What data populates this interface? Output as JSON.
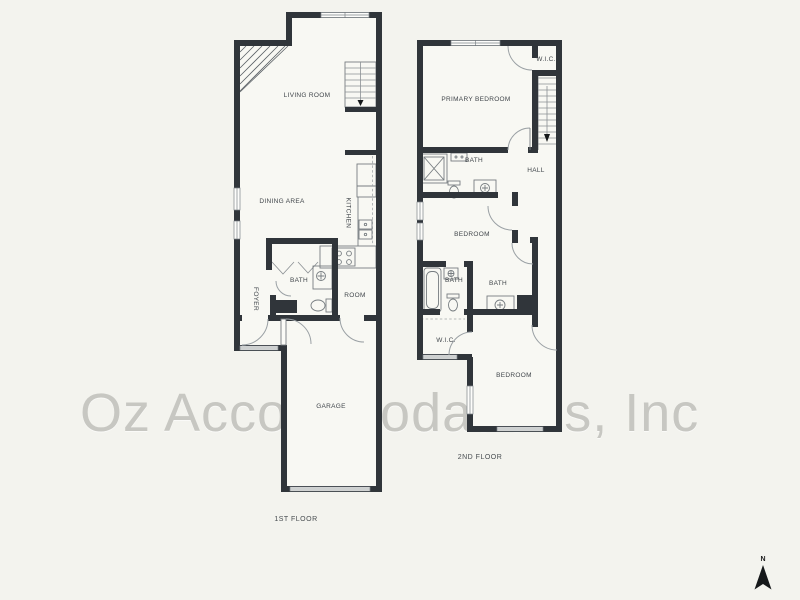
{
  "watermark": {
    "text": "Oz Accommodations, Inc"
  },
  "compass": {
    "north_label": "N"
  },
  "colors": {
    "page_background": "#f3f3ee",
    "floor_background": "#f8f8f3",
    "wall": "#30353a",
    "watermark_text": "#c7c7c2",
    "room_label": "#41464b"
  },
  "floor1": {
    "floor_label": "1ST FLOOR",
    "rooms": {
      "living_room": "LIVING ROOM",
      "dining_area": "DINING AREA",
      "kitchen": "KITCHEN",
      "bath": "BATH",
      "room": "ROOM",
      "foyer": "FOYER",
      "garage": "GARAGE"
    }
  },
  "floor2": {
    "floor_label": "2ND FLOOR",
    "rooms": {
      "primary_bedroom": "PRIMARY BEDROOM",
      "wic_upper": "W.I.C.",
      "primary_bath": "BATH",
      "hall": "HALL",
      "bedroom_middle": "BEDROOM",
      "bath_left": "BATH",
      "bath_right": "BATH",
      "wic_lower": "W.I.C.",
      "bedroom_lower": "BEDROOM"
    }
  }
}
